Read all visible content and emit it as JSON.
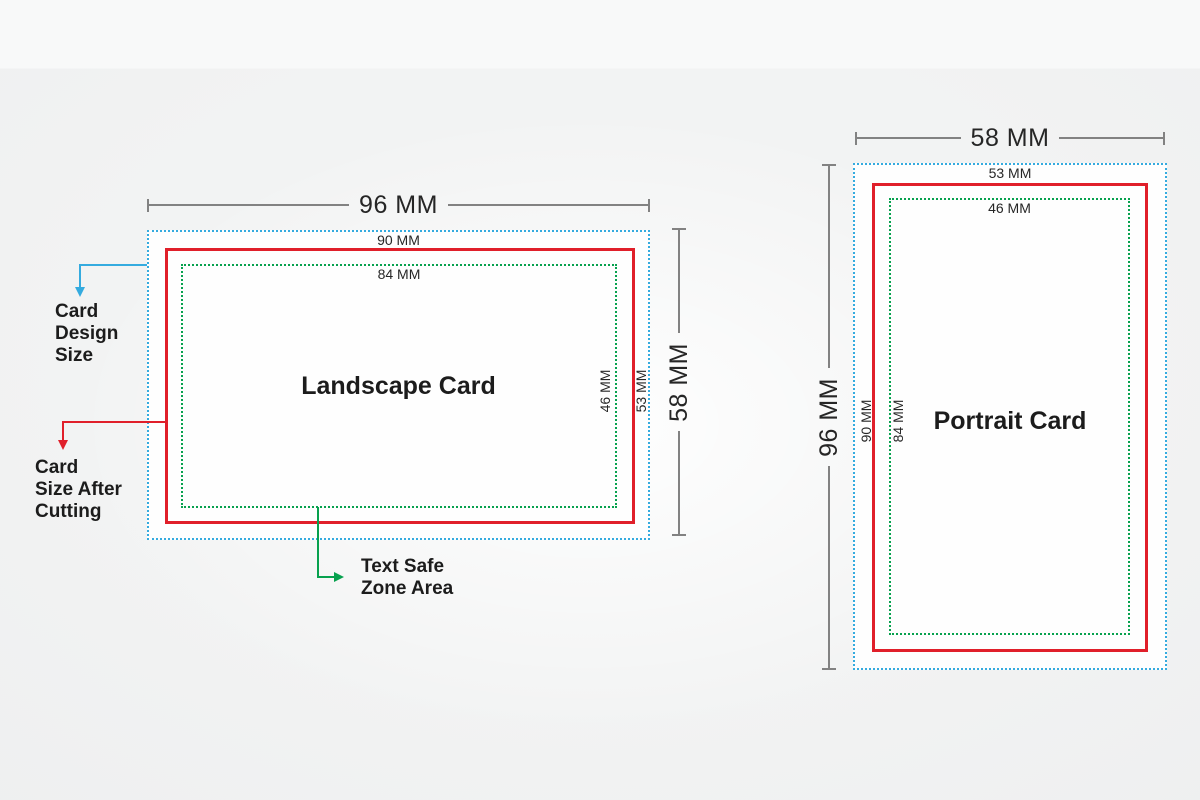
{
  "colors": {
    "design_size": "#35abdf",
    "cut_size": "#e01f2a",
    "safe_zone": "#07a14e",
    "dimension_line": "#828282",
    "text": "#1f1f1f"
  },
  "legend": {
    "design_size_label": "Card\nDesign\nSize",
    "cut_size_label": "Card\nSize After\nCutting",
    "safe_zone_label": "Text Safe\nZone Area"
  },
  "landscape_card": {
    "title": "Landscape Card",
    "design_width": "96 MM",
    "cut_width": "90 MM",
    "safe_width": "84 MM",
    "design_height": "58 MM",
    "cut_height": "53 MM",
    "safe_height": "46 MM"
  },
  "portrait_card": {
    "title": "Portrait Card",
    "design_width": "58 MM",
    "cut_width": "53 MM",
    "safe_width": "46 MM",
    "design_height": "96 MM",
    "cut_height": "90 MM",
    "safe_height": "84 MM"
  }
}
